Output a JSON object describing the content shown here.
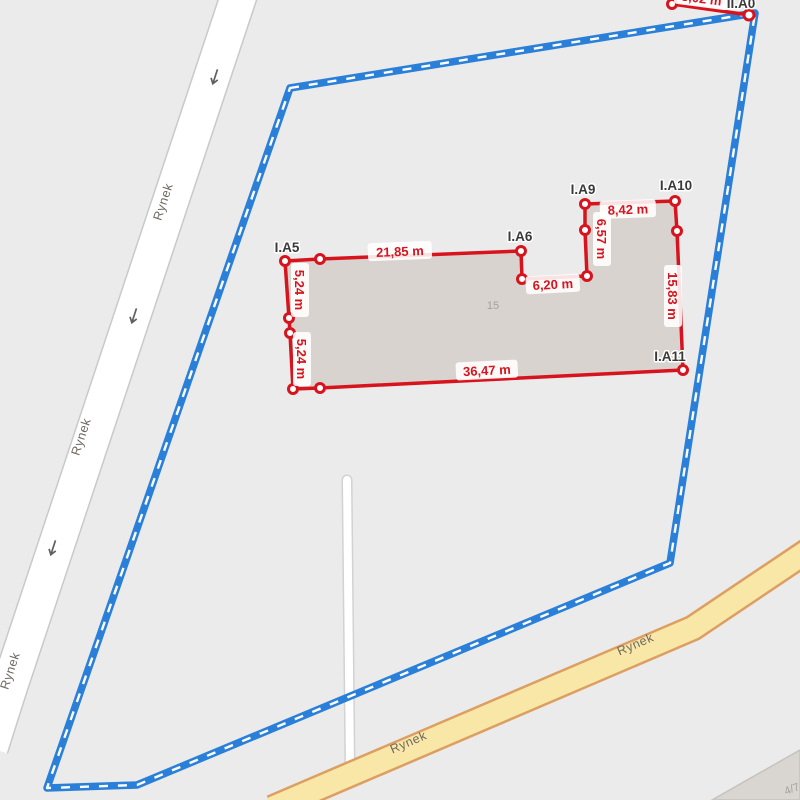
{
  "map": {
    "background_color": "#ebebeb",
    "road_name": "Rynek",
    "parcel_number": "4/7",
    "building_number": "15"
  },
  "boundary": {
    "color": "#2a80d8",
    "style": "solid blue with white dashes"
  },
  "building": {
    "outline_color": "#d7141e",
    "fill_color": "#d8d3ce"
  },
  "roads": {
    "west_road_fill": "#ffffff",
    "south_road_fill": "#f8e7a6",
    "south_road_casing": "#dc9f61"
  },
  "survey_points": {
    "ia5": "I.A5",
    "ia6": "I.A6",
    "ia9": "I.A9",
    "ia10": "I.A10",
    "ia11": "I.A11",
    "iia0": "II.A0"
  },
  "measurements": {
    "color": "#d7141e",
    "ia5_ia6": "21,85 m",
    "ia5_mid_left": "5,24 m",
    "mid_left_corner": "5,24 m",
    "ia6_step": "6,20 m",
    "ia9_step": "6,57 m",
    "ia9_ia10": "8,42 m",
    "ia10_ia11": "15,83 m",
    "bottom_edge": "36,47 m",
    "iia0_edge": "8,02 m"
  }
}
